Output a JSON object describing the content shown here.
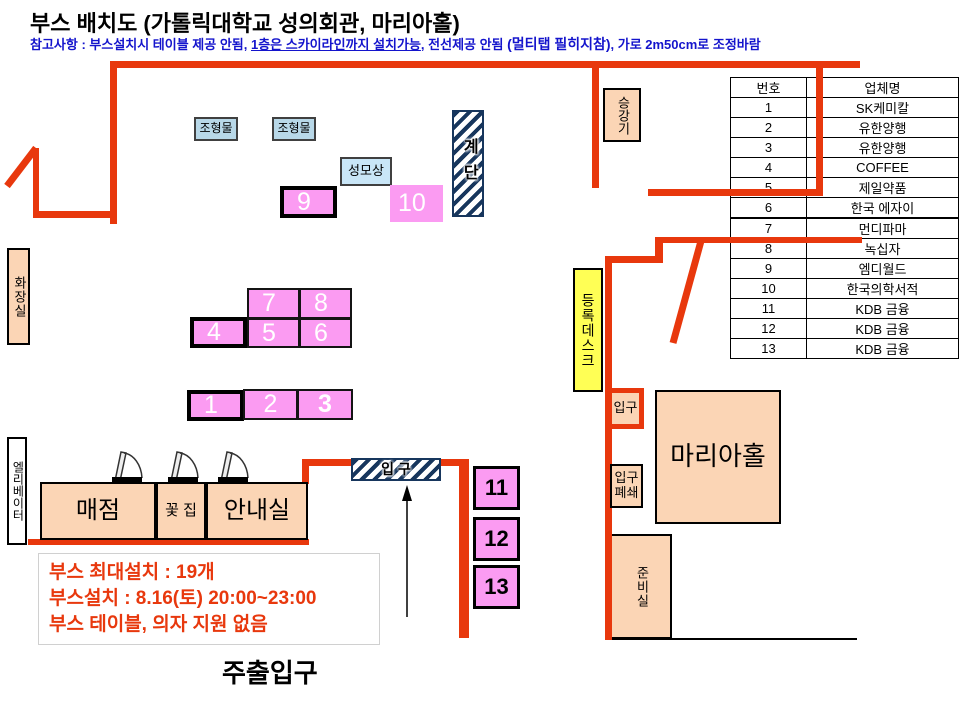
{
  "title": "부스 배치도 (가톨릭대학교 성의회관, 마리아홀)",
  "note": {
    "prefix": "참고사항 : 부스설치시 테이블 제공 안됨, ",
    "underlined": "1층은 스카이라인까지 설치가능",
    "mid": ", 전선제공 안됨 ",
    "bold": "(멀티탭 필히지참)",
    "suffix": ", 가로 2m50cm로 조정바람"
  },
  "company_table": {
    "headers": [
      "번호",
      "업체명"
    ],
    "rows": [
      [
        "1",
        "SK케미칼"
      ],
      [
        "2",
        "유한양행"
      ],
      [
        "3",
        "유한양행"
      ],
      [
        "4",
        "COFFEE"
      ],
      [
        "5",
        "제일약품"
      ],
      [
        "6",
        "한국 에자이"
      ],
      [
        "7",
        "먼디파마"
      ],
      [
        "8",
        "녹십자"
      ],
      [
        "9",
        "엠디월드"
      ],
      [
        "10",
        "한국의학서적"
      ],
      [
        "11",
        "KDB 금융"
      ],
      [
        "12",
        "KDB 금융"
      ],
      [
        "13",
        "KDB 금융"
      ]
    ]
  },
  "booths": [
    "1",
    "2",
    "3",
    "4",
    "5",
    "6",
    "7",
    "8",
    "9",
    "10",
    "11",
    "12",
    "13"
  ],
  "rooms": {
    "restroom": "화장실",
    "elevator_left": "엘리베이터",
    "sculpture1": "조형물",
    "sculpture2": "조형물",
    "statue": "성모상",
    "stairs": "계단",
    "lift_right": "승강기",
    "registration_desk": "등록데스크",
    "entrance_small": "입구",
    "maria_hall": "마리아홀",
    "entrance_closed": "입구폐쇄",
    "prep_room": "준비실",
    "store": "매점",
    "flower_shop": "꽃 집",
    "info_room": "안내실",
    "entrance_hatch": "입 구"
  },
  "info_box": {
    "line1": "부스 최대설치 : 19개",
    "line2": "부스설치 : 8.16(토) 20:00~23:00",
    "line3": "부스 테이블, 의자 지원 없음"
  },
  "main_entrance_label": "주출입구",
  "colors": {
    "wall_red": "#E8380D",
    "booth_pink": "#FB9BF2",
    "room_peach": "#FBD5B5",
    "label_blue": "#B8D8E8",
    "desk_yellow": "#FFFF55",
    "hatch_navy": "#17365D",
    "note_blue": "#1414CC",
    "info_red": "#E8380D"
  }
}
